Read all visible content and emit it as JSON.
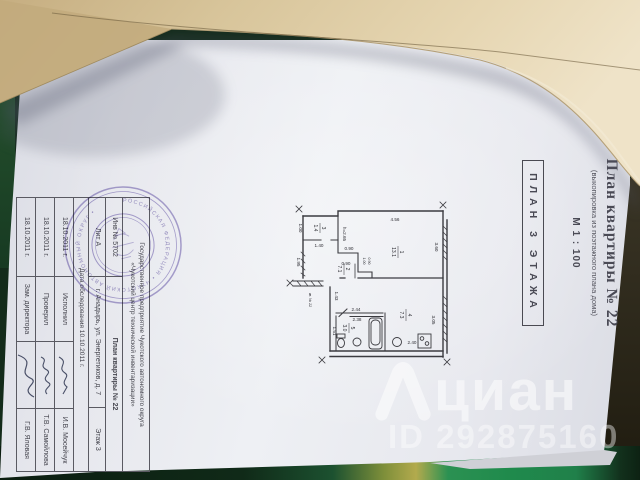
{
  "watermark": {
    "brand": "циан",
    "id": "ID 292875160"
  },
  "doc": {
    "title": "План квартиры № 22",
    "subtitle": "(выкопировка из поэтажного плана дома)",
    "scale": "М 1 : 100",
    "plan_label": "ПЛАН 3 ЭТАЖА",
    "stamp_ring": "РОССИЙСКАЯ ФЕДЕРАЦИЯ • ЧУКОТСКИЙ АВТОНОМНЫЙ ОКРУГ •",
    "table": {
      "org_line1": "Государственное предприятие Чукотского автономного округа",
      "org_line2": "«Чукотский центр технической инвентаризации»",
      "inv": "Инв № 5702",
      "doc_name": "План квартиры № 22",
      "lit": "Лит А",
      "address": "г. Анадырь, ул. Энергетиков, д. 7",
      "floor": "Этаж 3",
      "survey": "Дата обследования  10.10.2011 г.",
      "rows": [
        {
          "date": "18.10.2011 г.",
          "role": "Исполнил",
          "name": "И.В. Мосейчук"
        },
        {
          "date": "18.10.2011 г.",
          "role": "Проверил",
          "name": "Т.В. Самойлова"
        },
        {
          "date": "18.10.2011 г.",
          "role": "Зам. директора",
          "name": "Г.В. Яловая"
        }
      ]
    }
  },
  "plan": {
    "apartment": "кв. № 22",
    "rooms": {
      "r1": {
        "num": "1",
        "area": "13.1"
      },
      "r2": {
        "num": "2",
        "area": "7.1"
      },
      "r3": {
        "num": "3",
        "area": "1.4"
      },
      "r4": {
        "num": "4",
        "area": "7.3"
      },
      "r5": {
        "num": "5",
        "area": "3.0"
      }
    },
    "dims": {
      "top": "4.56",
      "right1": "3.60",
      "right2": "3.05",
      "balc_w": "1.40",
      "balc_h": "1.00",
      "left": "1.95",
      "height": "h=2.65",
      "st1": "0.90",
      "st2": "0.90",
      "st3": "1.00",
      "st4": "0.90",
      "hall": "1.43",
      "bath1": "2.44",
      "bath2": "2.38",
      "bath_l": "1.51",
      "kit_w": "2.40"
    }
  }
}
